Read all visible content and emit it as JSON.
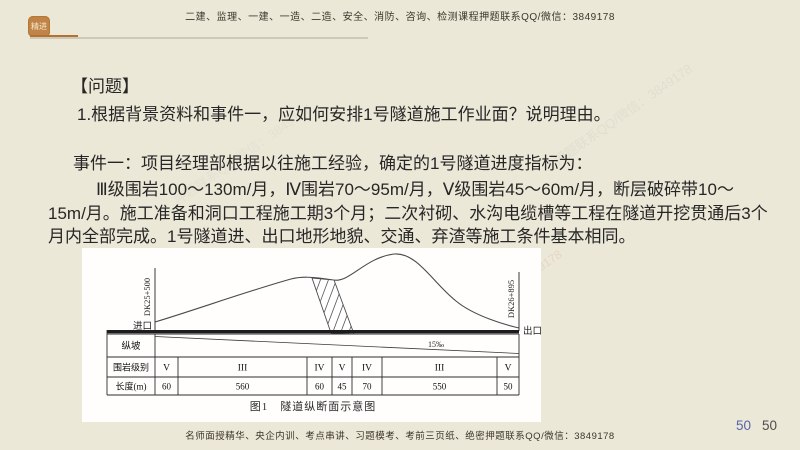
{
  "header": {
    "logo_text": "精进",
    "banner": "二建、监理、一建、一造、二造、安全、消防、咨询、检测课程押题联系QQ/微信：3849178"
  },
  "question": {
    "label": "【问题】",
    "line": "1.根据背景资料和事件一，应如何安排1号隧道施工作业面？说明理由。"
  },
  "event": {
    "lines": [
      "事件一：项目经理部根据以往施工经验，确定的1号隧道进度指标为：",
      "Ⅲ级围岩100～130m/月，Ⅳ围岩70～95m/月，Ⅴ级围岩45～60m/月，断层破碎带10～",
      "15m/月。施工准备和洞口工程施工期3个月；二次衬砌、水沟电缆槽等工程在隧道开挖贯通后3个",
      "月内全部完成。1号隧道进、出口地形地貌、交通、弃渣等施工条件基本相同。"
    ]
  },
  "figure": {
    "caption": "图1　隧道纵断面示意图",
    "entrance_label": "进口",
    "exit_label": "出口",
    "entrance_chainage": "DK25+500",
    "exit_chainage": "DK26+895",
    "slope_label": "15‰",
    "table": {
      "row_headers": [
        "纵坡",
        "围岩级别",
        "长度(m)"
      ],
      "rock_grades": [
        "V",
        "III",
        "IV",
        "V",
        "IV",
        "III",
        "V"
      ],
      "lengths": [
        "60",
        "560",
        "60",
        "45",
        "70",
        "550",
        "50"
      ]
    }
  },
  "footer": {
    "text": "名师面授精华、央企内训、考点串讲、习题模考、考前三页纸、绝密押题联系QQ/微信：3849178",
    "page_number_primary": "50",
    "page_number_secondary": "50"
  },
  "watermark": {
    "text": "押题联系QQ/微信：3849178"
  }
}
